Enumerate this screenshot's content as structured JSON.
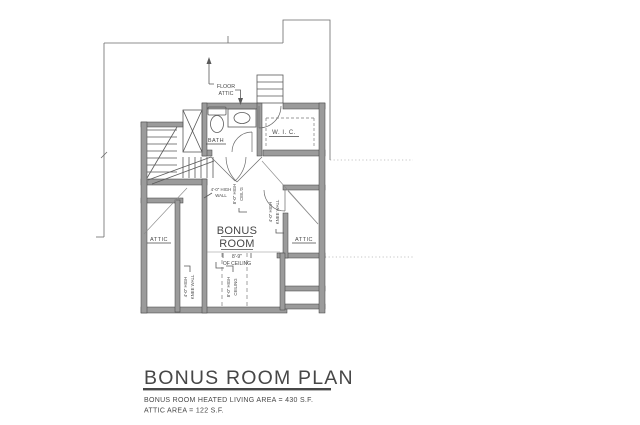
{
  "drawing": {
    "rooms": {
      "bath": "BATH",
      "wic": "W. I. C.",
      "attic_left": "ATTIC",
      "attic_right": "ATTIC",
      "bonus_room_line1": "BONUS",
      "bonus_room_line2": "ROOM"
    },
    "annotations": {
      "floor_attic_line1": "FLOOR",
      "floor_attic_line2": "ATTIC",
      "wall_note_line1": "4'-0\" HIGH",
      "wall_note_line2": "WALL",
      "ceiling_upper_line1": "8'-0\" HIGH",
      "ceiling_upper_line2": "CEIL'G",
      "knee_right_line1": "4'-0\" HIGH",
      "knee_right_line2": "KNEE WALL",
      "knee_bottom_line1": "4'-0\" HIGH",
      "knee_bottom_line2": "KNEE WALL",
      "ceiling_bottom_line1": "8'-0\" HIGH",
      "ceiling_bottom_line2": "CEILING",
      "flat_ceiling_dim_line1": "8'-9\"",
      "flat_ceiling_dim_line2": "OF CEILING"
    }
  },
  "title_block": {
    "title": "BONUS ROOM PLAN",
    "subtitle_line1": "BONUS ROOM HEATED LIVING AREA = 430 S.F.",
    "subtitle_line2": "ATTIC AREA = 122 S.F."
  },
  "colors": {
    "linework": "#4a4a4a",
    "wall_fill": "#9b9b9b",
    "background": "#ffffff"
  }
}
